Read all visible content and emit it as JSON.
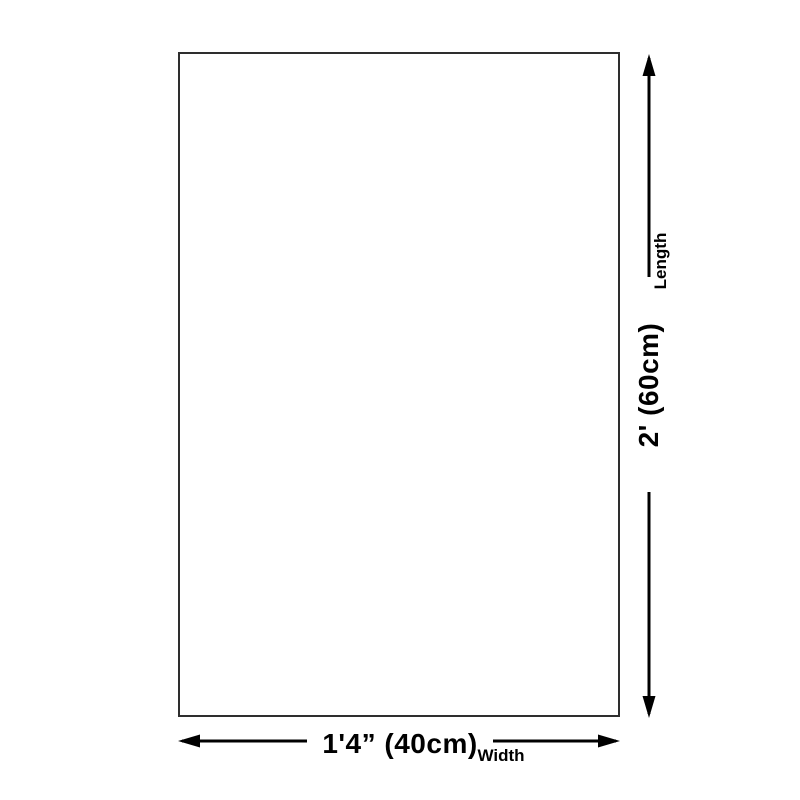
{
  "dimensions": {
    "length": {
      "label": "Length",
      "value": "2' (60cm)"
    },
    "width": {
      "label": "Width",
      "value": "1'4” (40cm)"
    }
  },
  "icons": {
    "length_arrow": "double-headed-vertical-arrow",
    "width_arrow": "double-headed-horizontal-arrow"
  },
  "colors": {
    "background": "#ffffff",
    "box_border": "#2e2e2e",
    "arrow_line": "#000000",
    "text": "#000000"
  }
}
